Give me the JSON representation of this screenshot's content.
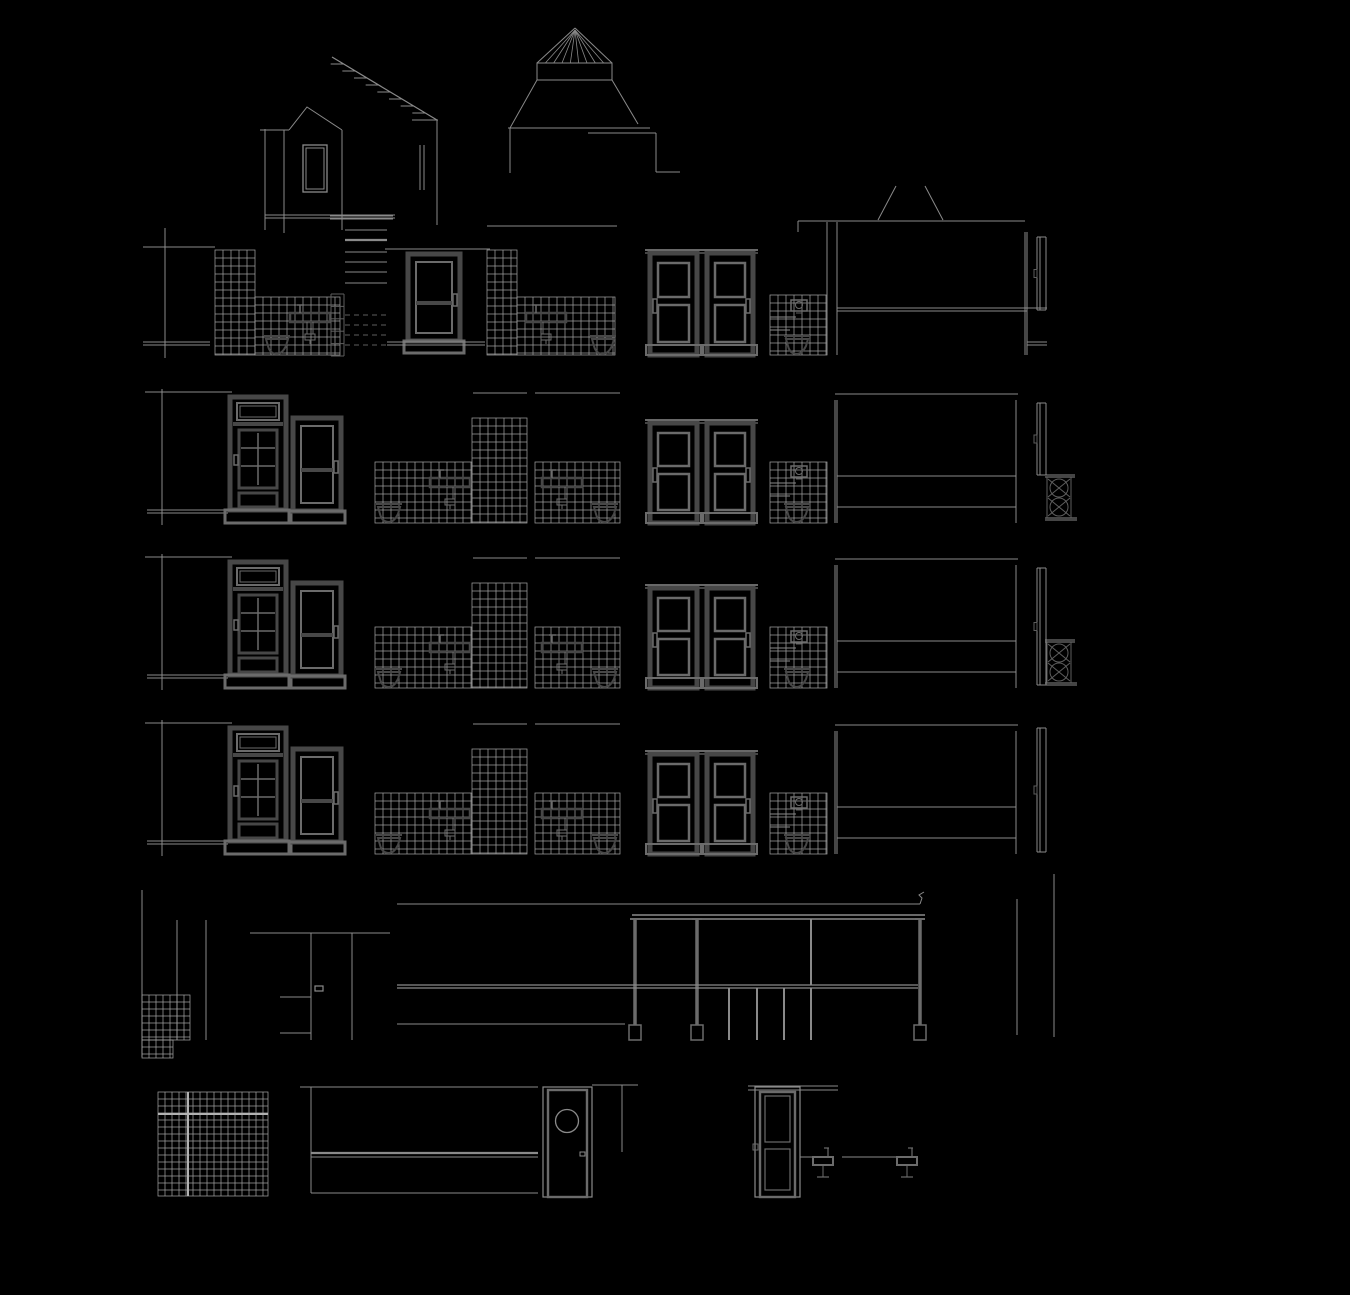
{
  "canvas": {
    "width": 1350,
    "height": 1295
  },
  "colors": {
    "background": "#000000",
    "line": "#8a8a8a",
    "faint": "#5e5e5e",
    "bright": "#b2b2b2",
    "tile": "#9d9d9d",
    "dark": "#474747",
    "mid": "#6b6b6b"
  },
  "roof": [
    {
      "t": "battens",
      "n": "main-roof-slope",
      "x1": 332,
      "y1": 57,
      "x2": 437,
      "y2": 120,
      "ticks": 8
    },
    {
      "t": "line",
      "n": "roof-eaves-line",
      "x1": 412,
      "y1": 120,
      "x2": 438,
      "y2": 120
    },
    {
      "t": "line",
      "n": "roof-right-edge",
      "x1": 437,
      "y1": 120,
      "x2": 437,
      "y2": 225
    },
    {
      "t": "line",
      "n": "chimney-flue-line",
      "x1": 420,
      "y1": 145,
      "x2": 420,
      "y2": 190
    },
    {
      "t": "line",
      "n": "chimney-flue-line-2",
      "x1": 424,
      "y1": 145,
      "x2": 424,
      "y2": 190
    },
    {
      "t": "poly",
      "n": "dormer-gable-outline",
      "pts": [
        [
          289,
          130
        ],
        [
          307,
          107
        ],
        [
          342,
          130
        ]
      ]
    },
    {
      "t": "line",
      "n": "dormer-eaves-line",
      "x1": 260,
      "y1": 130,
      "x2": 289,
      "y2": 130
    },
    {
      "t": "line",
      "n": "dormer-left-wall",
      "x1": 265,
      "y1": 129,
      "x2": 265,
      "y2": 230
    },
    {
      "t": "line",
      "n": "dormer-wall-line",
      "x1": 284,
      "y1": 130,
      "x2": 284,
      "y2": 233
    },
    {
      "t": "line",
      "n": "dormer-right-wall",
      "x1": 342,
      "y1": 130,
      "x2": 342,
      "y2": 230
    },
    {
      "t": "rect",
      "n": "dormer-window-frame",
      "x": 303,
      "y": 145,
      "w": 24,
      "h": 47,
      "sw": 1.3
    },
    {
      "t": "rect",
      "n": "dormer-window-glass",
      "x": 306,
      "y": 148,
      "w": 18,
      "h": 41,
      "sw": 1
    },
    {
      "t": "dline",
      "n": "dormer-floor-lines",
      "x1": 265,
      "x2": 395,
      "y": 215,
      "gap": 3
    },
    {
      "t": "cone_cap",
      "n": "skylight-cone-roof",
      "ax": 575,
      "ay": 28,
      "bx1": 537,
      "bx2": 612,
      "by": 63,
      "radials": 8
    },
    {
      "t": "rect",
      "n": "skylight-drum-band",
      "x": 537,
      "y": 63,
      "w": 75,
      "h": 17,
      "sw": 1
    },
    {
      "t": "line",
      "n": "skylight-skirt-left",
      "x1": 537,
      "y1": 80,
      "x2": 510,
      "y2": 128
    },
    {
      "t": "line",
      "n": "skylight-skirt-right",
      "x1": 612,
      "y1": 80,
      "x2": 638,
      "y2": 124
    },
    {
      "t": "line",
      "n": "skylight-base-line",
      "x1": 508,
      "y1": 128,
      "x2": 650,
      "y2": 128
    },
    {
      "t": "line",
      "n": "rear-wall-line",
      "x1": 510,
      "y1": 128,
      "x2": 510,
      "y2": 173
    },
    {
      "t": "line",
      "n": "rear-roof-line",
      "x1": 588,
      "y1": 133,
      "x2": 656,
      "y2": 133
    },
    {
      "t": "line",
      "n": "rear-roof-edge",
      "x1": 656,
      "y1": 133,
      "x2": 656,
      "y2": 172
    },
    {
      "t": "line",
      "n": "rear-parapet-line",
      "x1": 656,
      "y1": 172,
      "x2": 680,
      "y2": 172
    },
    {
      "t": "line",
      "n": "annex-chimney-left",
      "x1": 878,
      "y1": 220,
      "x2": 896,
      "y2": 186
    },
    {
      "t": "line",
      "n": "annex-chimney-right",
      "x1": 925,
      "y1": 186,
      "x2": 943,
      "y2": 220
    }
  ],
  "attic": [
    {
      "t": "line",
      "n": "left-section-cut-line",
      "x1": 165,
      "y1": 228,
      "x2": 165,
      "y2": 358
    },
    {
      "t": "line",
      "n": "attic-ceiling-line",
      "x1": 143,
      "y1": 247,
      "x2": 215,
      "y2": 247
    },
    {
      "t": "tiles",
      "n": "shower-tiled-wall",
      "x": 215,
      "y": 250,
      "w": 40,
      "h": 105,
      "cell": 8
    },
    {
      "t": "tiles",
      "n": "bathroom-tiled-wall",
      "x": 255,
      "y": 297,
      "w": 85,
      "h": 58,
      "cell": 8
    },
    {
      "t": "toilet",
      "n": "bathroom-toilet",
      "x": 264,
      "y": 335
    },
    {
      "t": "sink",
      "n": "bathroom-washbasin",
      "x": 290,
      "y": 313
    },
    {
      "t": "ladder",
      "n": "loft-ladder",
      "x": 331,
      "y": 294,
      "w": 13,
      "h": 62,
      "rungs": 5
    },
    {
      "t": "stairs",
      "n": "attic-stair-treads",
      "x1": 345,
      "x2": 387,
      "solid": [
        230,
        252,
        262,
        272,
        283
      ],
      "thick": [
        240
      ],
      "dashed": [
        315,
        325,
        335,
        345
      ]
    },
    {
      "t": "dline",
      "n": "stair-ceiling-lines",
      "x1": 330,
      "x2": 393,
      "y": 216,
      "gap": 3
    },
    {
      "t": "line",
      "n": "landing-ceiling-line",
      "x1": 385,
      "y1": 249,
      "x2": 490,
      "y2": 249
    },
    {
      "t": "door_plain",
      "n": "attic-room-door",
      "x": 408,
      "y": 254,
      "w": 52,
      "h": 99
    },
    {
      "t": "dline",
      "n": "floor-lines-left",
      "x1": 143,
      "x2": 210,
      "y": 342,
      "gap": 3
    },
    {
      "t": "dline",
      "n": "floor-lines-center",
      "x1": 387,
      "x2": 485,
      "y": 342,
      "gap": 3
    },
    {
      "t": "tiles",
      "n": "bathroom2-tiled-column",
      "x": 487,
      "y": 250,
      "w": 30,
      "h": 105,
      "cell": 8
    },
    {
      "t": "tiles",
      "n": "bathroom2-tiled-wall",
      "x": 517,
      "y": 297,
      "w": 98,
      "h": 58,
      "cell": 8
    },
    {
      "t": "line",
      "n": "bathroom2-ceiling-line",
      "x1": 487,
      "y1": 226,
      "x2": 617,
      "y2": 226
    },
    {
      "t": "sink",
      "n": "bathroom2-washbasin",
      "x": 526,
      "y": 313
    },
    {
      "t": "toilet",
      "n": "bathroom2-toilet",
      "x": 590,
      "y": 335
    },
    {
      "t": "door_flush",
      "n": "bedroom-door-left",
      "x": 650,
      "y": 250,
      "w": 47,
      "h": 105,
      "handle": "left"
    },
    {
      "t": "door_flush",
      "n": "bedroom-door-right",
      "x": 707,
      "y": 250,
      "w": 46,
      "h": 105,
      "handle": "right"
    },
    {
      "t": "tiles",
      "n": "wc-tiled-wall",
      "x": 770,
      "y": 295,
      "w": 57,
      "h": 60,
      "cell": 8
    },
    {
      "t": "cistern",
      "n": "wc-cistern",
      "x": 791,
      "y": 300
    },
    {
      "t": "line",
      "n": "wc-shelf-line",
      "x1": 770,
      "y1": 317,
      "x2": 796,
      "y2": 317
    },
    {
      "t": "line",
      "n": "wc-shelf-line-2",
      "x1": 770,
      "y1": 330,
      "x2": 790,
      "y2": 330
    },
    {
      "t": "toilet",
      "n": "wc-toilet",
      "x": 784,
      "y": 335
    },
    {
      "t": "line",
      "n": "attic-room-ceiling-line",
      "x1": 798,
      "y1": 221,
      "x2": 1025,
      "y2": 221
    },
    {
      "t": "line",
      "n": "attic-room-wall-edge",
      "x1": 798,
      "y1": 221,
      "x2": 798,
      "y2": 232
    },
    {
      "t": "line",
      "n": "room-left-wall-line",
      "x1": 827,
      "y1": 222,
      "x2": 827,
      "y2": 355
    },
    {
      "t": "line",
      "n": "room-left-wall-line-2",
      "x1": 837,
      "y1": 222,
      "x2": 837,
      "y2": 355
    },
    {
      "t": "line",
      "n": "room-right-wall-line",
      "x1": 1025,
      "y1": 232,
      "x2": 1025,
      "y2": 355
    },
    {
      "t": "line",
      "n": "room-right-wall-line-2",
      "x1": 1027,
      "y1": 232,
      "x2": 1027,
      "y2": 355
    },
    {
      "t": "dline",
      "n": "room-dado-lines",
      "x1": 837,
      "x2": 1027,
      "y": 308,
      "gap": 3
    },
    {
      "t": "line",
      "n": "right-dado-mark",
      "x1": 1027,
      "y1": 308,
      "x2": 1047,
      "y2": 308
    },
    {
      "t": "edge_door",
      "n": "side-door-edge",
      "x": 1037,
      "y1": 237,
      "y2": 310
    },
    {
      "t": "dline",
      "n": "right-floor-lines",
      "x1": 1027,
      "x2": 1047,
      "y": 342,
      "gap": 3
    }
  ],
  "floor_module": [
    {
      "t": "line",
      "n": "floor-ceiling-line",
      "x1": 145,
      "y1": 0,
      "x2": 232,
      "y2": 0
    },
    {
      "t": "line",
      "n": "left-section-cut-line",
      "x1": 162,
      "y1": -3,
      "x2": 162,
      "y2": 133
    },
    {
      "t": "dline",
      "n": "floor-slab-lines",
      "x1": 147,
      "x2": 228,
      "y": 118,
      "gap": 3
    },
    {
      "t": "door_transom",
      "n": "stairhall-door",
      "x": 230,
      "y": 5,
      "w": 56,
      "h": 126
    },
    {
      "t": "door_plain",
      "n": "apartment-entrance-door",
      "x": 293,
      "y": 26,
      "w": 48,
      "h": 105
    },
    {
      "t": "line",
      "n": "bathroom-ceiling-line",
      "x1": 473,
      "y1": 1,
      "x2": 527,
      "y2": 1
    },
    {
      "t": "line",
      "n": "bathroom2-ceiling-line",
      "x1": 535,
      "y1": 1,
      "x2": 620,
      "y2": 1
    },
    {
      "t": "tiles",
      "n": "bathroom-tiled-wall-low",
      "x": 375,
      "y": 70,
      "w": 97,
      "h": 61,
      "cell": 8
    },
    {
      "t": "tiles",
      "n": "bathroom-tiled-wall-column",
      "x": 472,
      "y": 26,
      "w": 55,
      "h": 105,
      "cell": 8
    },
    {
      "t": "sink",
      "n": "bathroom-washbasin",
      "x": 430,
      "y": 86
    },
    {
      "t": "toilet",
      "n": "bathroom-toilet",
      "x": 376,
      "y": 111
    },
    {
      "t": "tiles",
      "n": "bathroom2-tiled-wall",
      "x": 535,
      "y": 70,
      "w": 85,
      "h": 61,
      "cell": 8
    },
    {
      "t": "sink",
      "n": "bathroom2-washbasin",
      "x": 542,
      "y": 86
    },
    {
      "t": "toilet",
      "n": "bathroom2-toilet",
      "x": 592,
      "y": 111
    },
    {
      "t": "door_flush",
      "n": "bedroom-door-left",
      "x": 650,
      "y": 28,
      "w": 47,
      "h": 103,
      "handle": "left"
    },
    {
      "t": "door_flush",
      "n": "bedroom-door-right",
      "x": 707,
      "y": 28,
      "w": 46,
      "h": 103,
      "handle": "right"
    },
    {
      "t": "tiles",
      "n": "wc-tiled-wall",
      "x": 770,
      "y": 70,
      "w": 57,
      "h": 61,
      "cell": 8
    },
    {
      "t": "cistern",
      "n": "wc-cistern",
      "x": 791,
      "y": 74
    },
    {
      "t": "line",
      "n": "wc-shelf-line",
      "x1": 770,
      "y1": 91,
      "x2": 796,
      "y2": 91
    },
    {
      "t": "line",
      "n": "wc-shelf-line-2",
      "x1": 770,
      "y1": 104,
      "x2": 790,
      "y2": 104
    },
    {
      "t": "toilet",
      "n": "wc-toilet",
      "x": 784,
      "y": 111
    },
    {
      "t": "line",
      "n": "room-ceiling-line",
      "x1": 835,
      "y1": 2,
      "x2": 1018,
      "y2": 2
    },
    {
      "t": "line",
      "n": "room-left-wall-line",
      "x1": 835,
      "y1": 8,
      "x2": 835,
      "y2": 131
    },
    {
      "t": "line",
      "n": "room-left-wall-line-2",
      "x1": 837,
      "y1": 8,
      "x2": 837,
      "y2": 131
    },
    {
      "t": "line",
      "n": "room-right-wall-line",
      "x1": 1016,
      "y1": 8,
      "x2": 1016,
      "y2": 131
    },
    {
      "t": "line",
      "n": "room-dado-line-upper",
      "x1": 837,
      "y1": 84,
      "x2": 1016,
      "y2": 84
    },
    {
      "t": "line",
      "n": "room-dado-line-lower",
      "x1": 837,
      "y1": 115,
      "x2": 1016,
      "y2": 115
    }
  ],
  "floors": [
    {
      "y": 392,
      "label": "third-floor",
      "edge_door": [
        11,
        83
      ],
      "radiator": true
    },
    {
      "y": 557,
      "label": "second-floor",
      "edge_door": [
        11,
        128
      ],
      "radiator": true
    },
    {
      "y": 723,
      "label": "first-floor",
      "edge_door": [
        5,
        129
      ],
      "radiator": false
    }
  ],
  "radiator_pos": {
    "x": 1047,
    "dy": 83
  },
  "ground": [
    {
      "t": "line",
      "n": "left-wall-cut-line",
      "x1": 142,
      "y1": 890,
      "x2": 142,
      "y2": 1057
    },
    {
      "t": "line",
      "n": "hall-wall-line",
      "x1": 177,
      "y1": 920,
      "x2": 177,
      "y2": 1040
    },
    {
      "t": "line",
      "n": "hall-wall-line-2",
      "x1": 206,
      "y1": 920,
      "x2": 206,
      "y2": 1040
    },
    {
      "t": "tiles",
      "n": "entry-tiled-wainscot",
      "x": 142,
      "y": 995,
      "w": 48,
      "h": 45,
      "cell": 7
    },
    {
      "t": "tiles",
      "n": "entry-tiled-wainscot-step",
      "x": 142,
      "y": 1040,
      "w": 31,
      "h": 18,
      "cell": 7
    },
    {
      "t": "line",
      "n": "entrance-lintel-line",
      "x1": 250,
      "y1": 933,
      "x2": 390,
      "y2": 933
    },
    {
      "t": "line",
      "n": "entrance-jamb-line",
      "x1": 311,
      "y1": 933,
      "x2": 311,
      "y2": 1040
    },
    {
      "t": "line",
      "n": "entrance-jamb-line-2",
      "x1": 352,
      "y1": 933,
      "x2": 352,
      "y2": 1040
    },
    {
      "t": "rect",
      "n": "entrance-door-handle",
      "x": 315,
      "y": 986,
      "w": 8,
      "h": 5,
      "sw": 1.2
    },
    {
      "t": "line",
      "n": "stair-rail-line",
      "x1": 280,
      "y1": 997,
      "x2": 311,
      "y2": 997
    },
    {
      "t": "line",
      "n": "stair-base-line",
      "x1": 280,
      "y1": 1033,
      "x2": 311,
      "y2": 1033
    },
    {
      "t": "line",
      "n": "shop-ceiling-line",
      "x1": 397,
      "y1": 904,
      "x2": 920,
      "y2": 904
    },
    {
      "t": "poly",
      "n": "gutter-profile",
      "pts": [
        [
          920,
          904
        ],
        [
          922,
          898
        ],
        [
          919,
          895
        ],
        [
          924,
          892
        ]
      ]
    },
    {
      "t": "dline",
      "n": "shopfront-beam-lines",
      "x1": 632,
      "x2": 925,
      "y": 915,
      "gap": 4,
      "w": 1.4
    },
    {
      "t": "column",
      "n": "shopfront-column-left",
      "x": 635,
      "y1": 919,
      "y2": 1040
    },
    {
      "t": "column",
      "n": "shopfront-column-mid",
      "x": 697,
      "y1": 919,
      "y2": 1040
    },
    {
      "t": "column",
      "n": "shopfront-column-right",
      "x": 920,
      "y1": 919,
      "y2": 1040
    },
    {
      "t": "dline",
      "n": "shopfront-transom-lines",
      "x1": 397,
      "x2": 918,
      "y": 985,
      "gap": 3,
      "w": 1.3
    },
    {
      "t": "line",
      "n": "shopfront-mullion",
      "x1": 811,
      "y1": 919,
      "x2": 811,
      "y2": 985,
      "w": 2
    },
    {
      "t": "line",
      "n": "stallboard-mullion-1",
      "x1": 729,
      "y1": 988,
      "x2": 729,
      "y2": 1040,
      "w": 2
    },
    {
      "t": "line",
      "n": "stallboard-mullion-2",
      "x1": 757,
      "y1": 988,
      "x2": 757,
      "y2": 1040,
      "w": 2
    },
    {
      "t": "line",
      "n": "stallboard-mullion-3",
      "x1": 784,
      "y1": 988,
      "x2": 784,
      "y2": 1040,
      "w": 2
    },
    {
      "t": "line",
      "n": "stallboard-mullion-4",
      "x1": 811,
      "y1": 988,
      "x2": 811,
      "y2": 1040,
      "w": 2
    },
    {
      "t": "line",
      "n": "shop-floor-line",
      "x1": 397,
      "y1": 1024,
      "x2": 625,
      "y2": 1024
    },
    {
      "t": "line",
      "n": "rear-wall-line",
      "x1": 1017,
      "y1": 899,
      "x2": 1017,
      "y2": 1035
    },
    {
      "t": "line",
      "n": "rear-wall-line-2",
      "x1": 1054,
      "y1": 874,
      "x2": 1054,
      "y2": 1037
    }
  ],
  "basement": [
    {
      "t": "tiles",
      "n": "cellar-tiled-wall",
      "x": 158,
      "y": 1092,
      "w": 110,
      "h": 104,
      "cell": 7
    },
    {
      "t": "line",
      "n": "cellar-tile-band-line",
      "x1": 158,
      "y1": 1114,
      "x2": 268,
      "y2": 1114,
      "w": 2,
      "c": "bright"
    },
    {
      "t": "line",
      "n": "cellar-tile-band-vertical",
      "x1": 188,
      "y1": 1092,
      "x2": 188,
      "y2": 1196,
      "w": 2,
      "c": "bright"
    },
    {
      "t": "line",
      "n": "cellar-ceiling-line",
      "x1": 300,
      "y1": 1087,
      "x2": 538,
      "y2": 1087
    },
    {
      "t": "line",
      "n": "cellar-wall-edge",
      "x1": 311,
      "y1": 1087,
      "x2": 311,
      "y2": 1193
    },
    {
      "t": "line",
      "n": "cellar-band-line",
      "x1": 311,
      "y1": 1153,
      "x2": 538,
      "y2": 1153,
      "w": 2.2
    },
    {
      "t": "line",
      "n": "cellar-band-line-2",
      "x1": 311,
      "y1": 1157,
      "x2": 538,
      "y2": 1157
    },
    {
      "t": "line",
      "n": "cellar-floor-line",
      "x1": 311,
      "y1": 1193,
      "x2": 538,
      "y2": 1193
    },
    {
      "t": "rect",
      "n": "porthole-door-frame",
      "x": 543,
      "y": 1087,
      "w": 49,
      "h": 110,
      "sw": 1.2
    },
    {
      "t": "rect",
      "n": "porthole-door-leaf",
      "x": 548,
      "y": 1090,
      "w": 39,
      "h": 107,
      "sw": 2.4,
      "c": "mid"
    },
    {
      "t": "circle",
      "n": "porthole-window",
      "cx": 567,
      "cy": 1121,
      "r": 11.5,
      "sw": 1.3
    },
    {
      "t": "rect",
      "n": "porthole-door-handle",
      "x": 580,
      "y": 1152,
      "w": 5,
      "h": 4,
      "sw": 1
    },
    {
      "t": "line",
      "n": "corridor-ceiling-line",
      "x1": 592,
      "y1": 1085,
      "x2": 638,
      "y2": 1085
    },
    {
      "t": "line",
      "n": "corridor-wall-line",
      "x1": 622,
      "y1": 1085,
      "x2": 622,
      "y2": 1152
    },
    {
      "t": "dline",
      "n": "cellar-door-lintel-lines",
      "x1": 748,
      "x2": 838,
      "y": 1086,
      "gap": 4
    },
    {
      "t": "door_cellar",
      "n": "cellar-door",
      "x": 755,
      "y": 1087,
      "w": 45,
      "h": 110
    },
    {
      "t": "line",
      "n": "washstand-wall-line",
      "x1": 800,
      "y1": 1157,
      "x2": 833,
      "y2": 1157
    },
    {
      "t": "basin",
      "n": "cellar-washbasin-1",
      "x": 813,
      "y": 1157
    },
    {
      "t": "line",
      "n": "washstand-wall-line-2",
      "x1": 842,
      "y1": 1157,
      "x2": 917,
      "y2": 1157
    },
    {
      "t": "basin",
      "n": "cellar-washbasin-2",
      "x": 897,
      "y": 1157
    }
  ]
}
